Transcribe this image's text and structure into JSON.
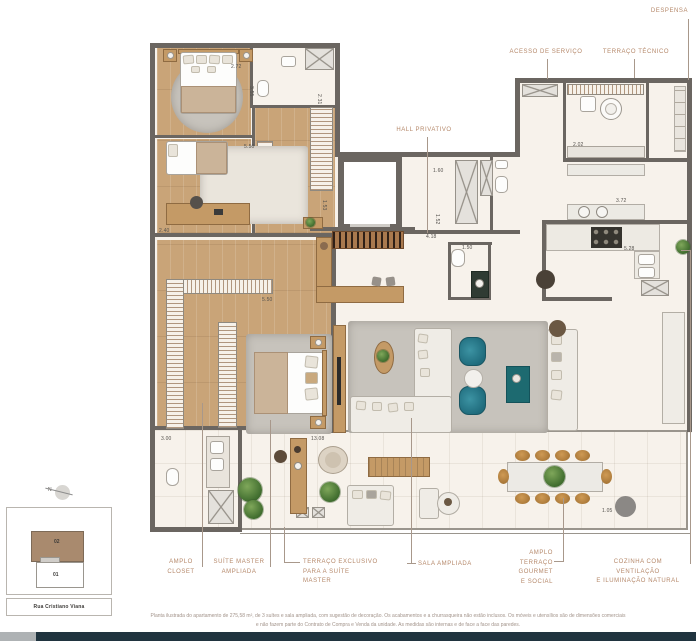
{
  "callouts": {
    "despensa": "DESPENSA",
    "acesso_de_servico": "ACESSO DE SERVIÇO",
    "terraco_tecnico": "TERRAÇO TÉCNICO",
    "hall_privativo": "HALL PRIVATIVO",
    "amplo_closet": "AMPLO\nCLOSET",
    "suite_master_ampliada": "SUÍTE MASTER\nAMPLIADA",
    "terraco_exclusivo": "TERRAÇO EXCLUSIVO\nPARA A SUÍTE MASTER",
    "sala_ampliada": "SALA AMPLIADA",
    "amplo_terraco": "AMPLO TERRAÇO\nGOURMET\nE SOCIAL",
    "cozinha": "COZINHA COM VENTILAÇÃO\nE ILUMINAÇÃO NATURAL"
  },
  "dims": [
    {
      "t": "2.72",
      "x": 231,
      "y": 64
    },
    {
      "t": "3.55",
      "x": 254,
      "y": 86,
      "r": 90
    },
    {
      "t": "2.31",
      "x": 322,
      "y": 94,
      "r": 90
    },
    {
      "t": "5.50",
      "x": 244,
      "y": 144
    },
    {
      "t": "1.53",
      "x": 327,
      "y": 200,
      "r": 90
    },
    {
      "t": "2.40",
      "x": 159,
      "y": 228
    },
    {
      "t": "1.60",
      "x": 433,
      "y": 168
    },
    {
      "t": "1.52",
      "x": 440,
      "y": 214,
      "r": 90
    },
    {
      "t": "4.18",
      "x": 426,
      "y": 234
    },
    {
      "t": "1.50",
      "x": 462,
      "y": 245
    },
    {
      "t": "2.02",
      "x": 573,
      "y": 142
    },
    {
      "t": "3.72",
      "x": 616,
      "y": 198
    },
    {
      "t": "5.28",
      "x": 624,
      "y": 246
    },
    {
      "t": "5.50",
      "x": 262,
      "y": 297
    },
    {
      "t": "13.08",
      "x": 311,
      "y": 436
    },
    {
      "t": "3.00",
      "x": 161,
      "y": 436
    },
    {
      "t": "1.05",
      "x": 602,
      "y": 508
    }
  ],
  "siteplan": {
    "north": "N",
    "unit_top": "02",
    "unit_bottom": "01",
    "street": "Rua Cristiano Viana"
  },
  "disclaimer": {
    "line1": "Planta ilustrada do apartamento de 275,58 m², de 3 suítes e sala ampliada, com sugestão de decoração. Os acabamentos e a churrasqueira não estão inclusos. Os móveis e utensílios são de dimensões comerciais",
    "line2": "e não fazem parte do Contrato de Compra e Venda da unidade. As medidas são internas e de face a face das paredes."
  },
  "palette": {
    "label_accent": "#b5886a",
    "wall": "#6b6661",
    "wood_floor": "#c9a478",
    "marble_floor": "#f7f2eb",
    "armchair_teal": "#2a7d8e",
    "footer_bar": "#20343f"
  }
}
